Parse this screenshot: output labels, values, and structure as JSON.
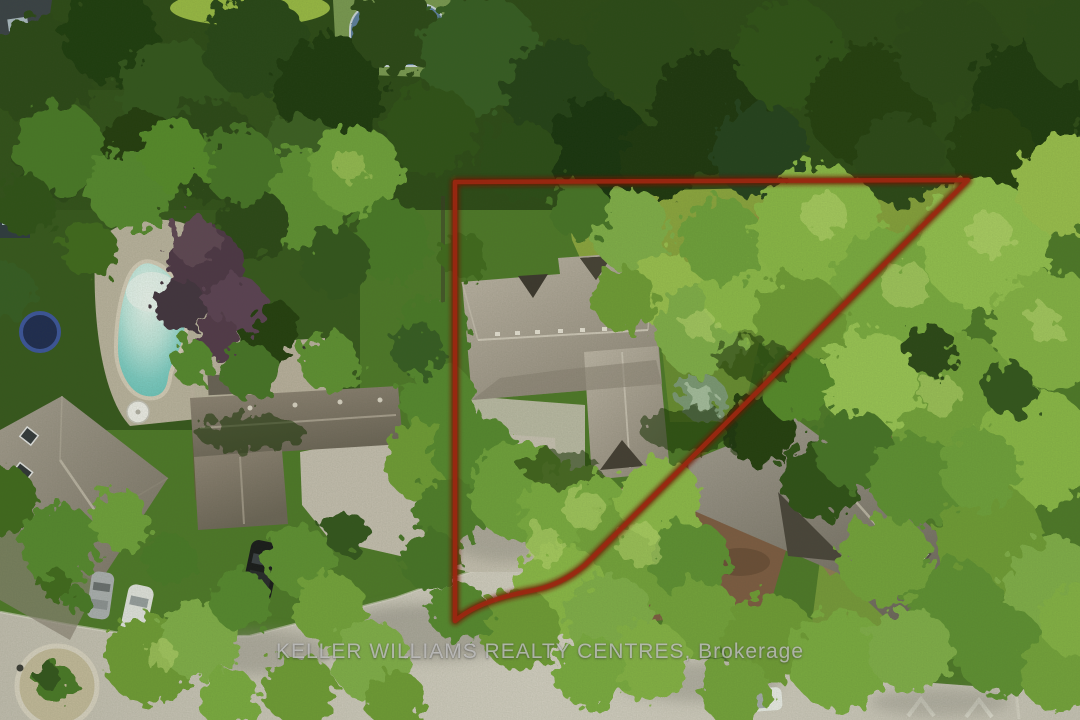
{
  "watermark": {
    "text": "KELLER WILLIAMS REALTY CENTRES, Brokerage"
  },
  "scene": {
    "type": "aerial-property-photo",
    "boundary_overlay_color": "#8a1d0c",
    "pool_water_color": "#6cc8c0",
    "road_color": "#d2cdc1",
    "main_roof_color": "#b3aa9d",
    "foliage_sunlit_color": "#8cbb47",
    "foliage_dark_color": "#223d10",
    "blue_tarp_color": "#3f74cb"
  }
}
